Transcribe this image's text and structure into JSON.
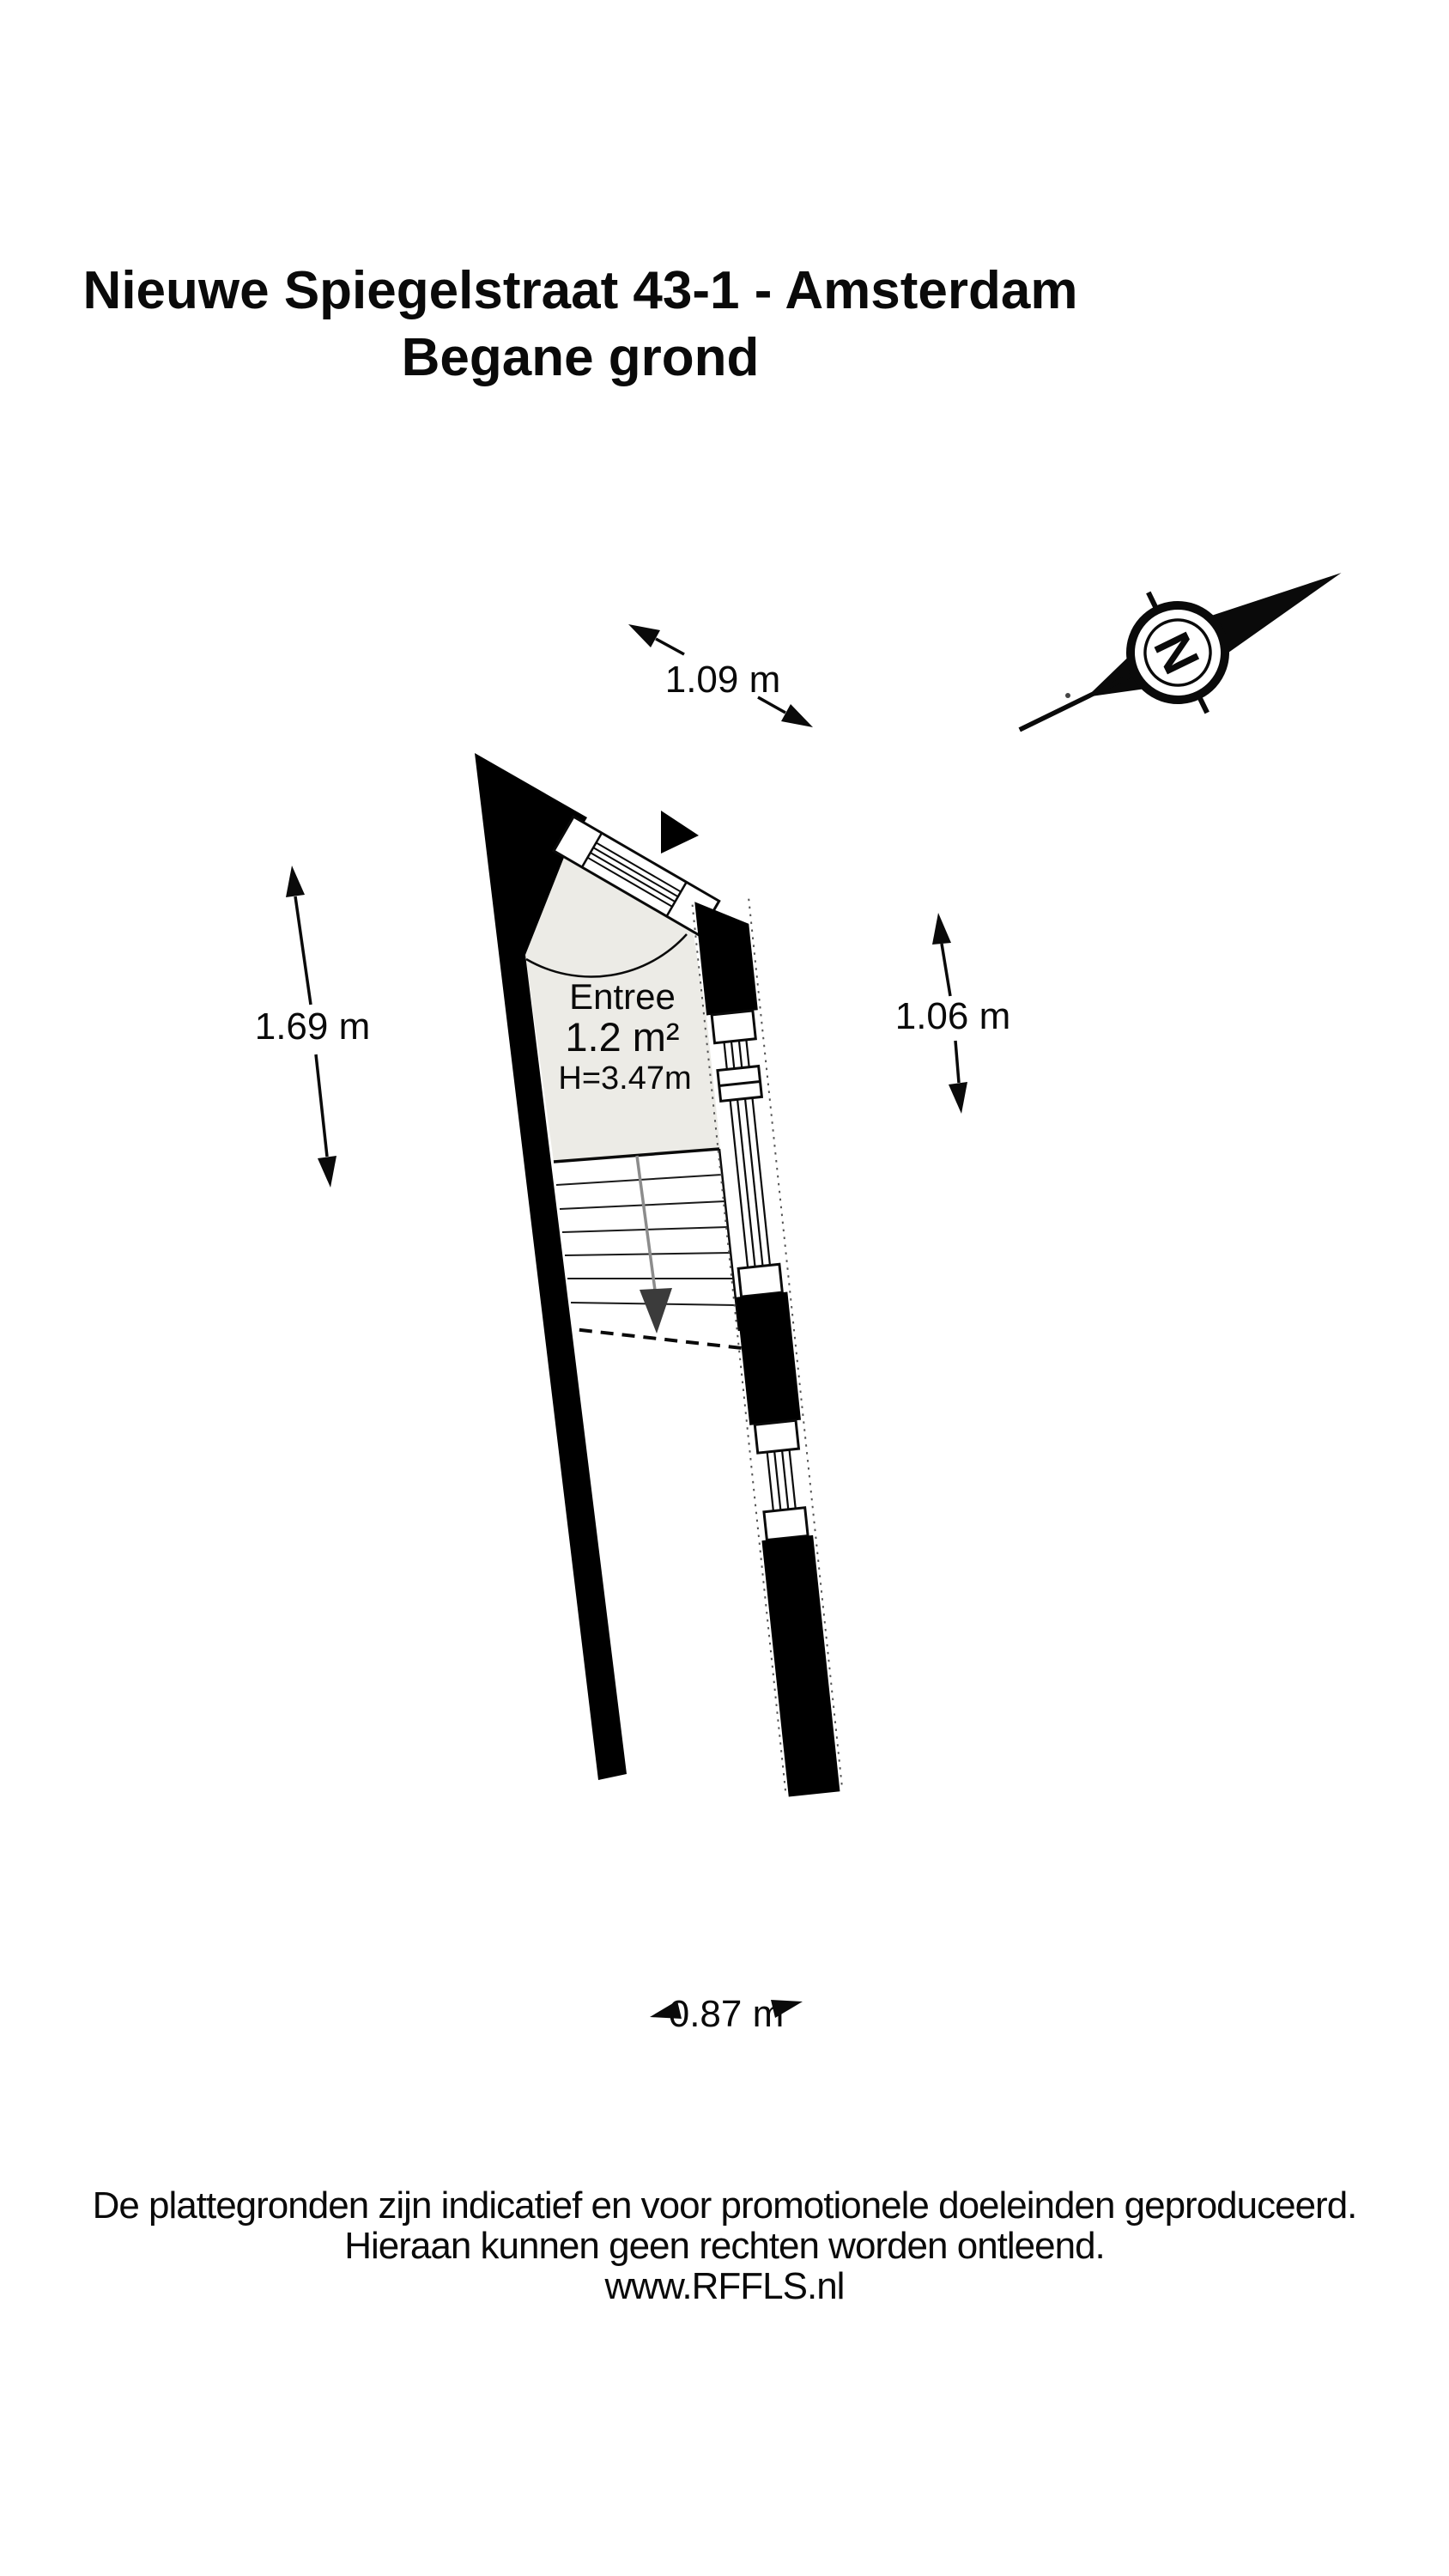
{
  "title": {
    "line1": "Nieuwe Spiegelstraat 43-1 - Amsterdam",
    "line2": "Begane grond"
  },
  "plan": {
    "room": {
      "name": "Entree",
      "area": "1.2 m²",
      "ceiling_height": "H=3.47m"
    },
    "dimensions": {
      "top": "1.09 m",
      "left": "1.69 m",
      "right": "1.06 m",
      "bottom": "0.87 m"
    },
    "compass": {
      "north_letter": "N"
    }
  },
  "footer": {
    "line1": "De plattegronden zijn indicatief en voor promotionele doeleinden geproduceerd.",
    "line2": "Hieraan kunnen geen rechten worden ontleend.",
    "line3": "www.RFFLS.nl"
  },
  "colors": {
    "ink": "#0a0a0a",
    "wall_fill": "#000000",
    "room_fill": "#ECEBE6",
    "stair_stringer": "#8c8c8c",
    "stair_arrow": "#3b3b3b"
  }
}
